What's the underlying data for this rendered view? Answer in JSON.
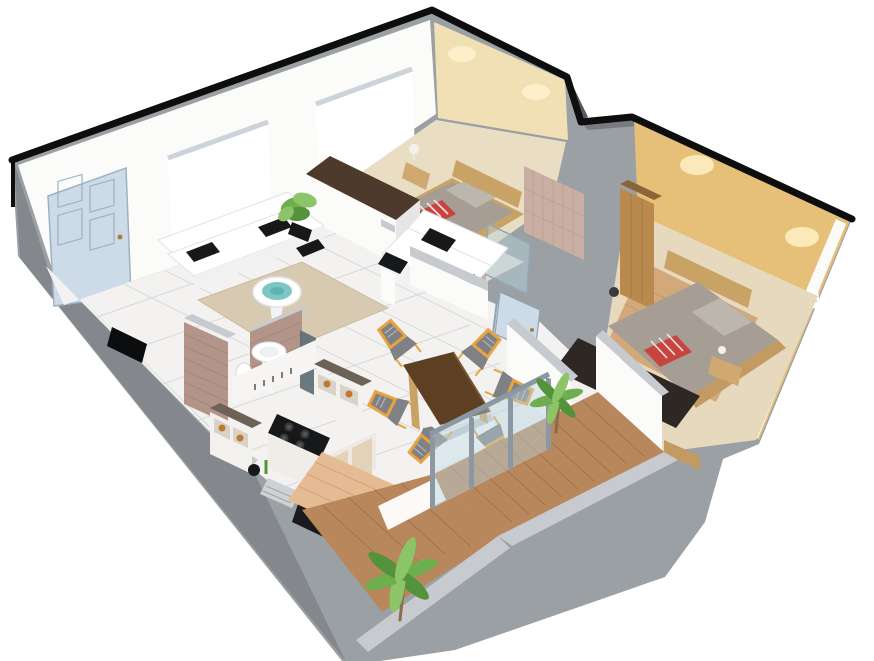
{
  "scene": {
    "type": "3d-floorplan-render",
    "title": "3D isometric cutaway floor plan of a two-bedroom apartment",
    "view": "dollhouse aerial from south",
    "rooms": [
      {
        "name": "Living Room",
        "furniture": [
          "entry-door",
          "window",
          "window",
          "three-seat-sofa",
          "two-seat-sofa",
          "black-cushions",
          "round-coffee-table",
          "area-rug",
          "flat-tv",
          "potted-plant"
        ]
      },
      {
        "name": "Bedroom Two",
        "furniture": [
          "double-bed",
          "wood-headboard",
          "striped-throw",
          "nightstand",
          "table-lamp",
          "wardrobe"
        ]
      },
      {
        "name": "Bathroom",
        "furniture": [
          "toilet",
          "washbasin",
          "glass-shower",
          "mosaic-walls",
          "open-door"
        ]
      },
      {
        "name": "Kitchen",
        "furniture": [
          "brick-partition",
          "pedestal-washbasin",
          "wc",
          "cooktop",
          "counter-cabinets",
          "shelf-unit-with-jars",
          "shelf-unit-with-jars",
          "black-appliance",
          "striped-mat",
          "wood-deck-floor"
        ]
      },
      {
        "name": "Dining Area",
        "furniture": [
          "wood-dining-table",
          "chair",
          "chair",
          "chair",
          "chair",
          "chair",
          "chair"
        ]
      },
      {
        "name": "Master Bedroom",
        "furniture": [
          "double-bed",
          "wood-headboard",
          "pillows",
          "striped-throw",
          "dark-bench",
          "nightstand",
          "table-lamp",
          "tall-wardrobe",
          "ac-unit",
          "gold-wallpaper-walls",
          "ceiling-spotlights"
        ]
      },
      {
        "name": "Hallway",
        "furniture": [
          "palm-plant",
          "open-door",
          "marble-floor"
        ]
      },
      {
        "name": "Balcony",
        "furniture": [
          "plank-deck",
          "palm-plant",
          "sliding-glass-door",
          "parapet-walls"
        ]
      }
    ]
  },
  "palette": {
    "shell": "#9ba0a4",
    "shellDark": "#84878c",
    "cap": "#c7cbd0",
    "capDark": "#6e6257",
    "cutBlack": "#0e0e0f",
    "wall": "#fbfbfa",
    "white": "#ffffff",
    "cream": "#f1e0b4",
    "creamGlow": "#fff3cf",
    "gold": "#e6c078",
    "goldGlow": "#fff0c4",
    "floor": "#f3f2f0",
    "grout": "#dcdcde",
    "floorBeige": "#e9ddc4",
    "floorTan": "#e7d9bd",
    "rug": "#d8cab0",
    "mosaic": "#c9aea4",
    "mosaicLine": "#b09287",
    "brick": "#b29588",
    "brickLine": "#9b8274",
    "woodLight": "#c9a265",
    "woodMid": "#b9894e",
    "woodDark": "#4e3a2c",
    "woodTrim": "#c29a62",
    "deck": "#b8875c",
    "deckLine": "#9c6f4a",
    "deckPink": "#e5bb94",
    "deckPinkLine": "#d3a27c",
    "bed": "#a69e95",
    "pillow": "#bdb6ad",
    "throwRed": "#c8453f",
    "chairYellow": "#e8a33d",
    "chairGray": "#7f8184",
    "tableTop": "#5d3f22",
    "teal": "#7cc7c4",
    "tealDark": "#5db3b0",
    "plant": "#6fae4e",
    "plantDark": "#55923c",
    "plantLight": "#8cc468",
    "trunk": "#8a6b4a",
    "glass": "#b8d2de",
    "frame": "#8b98a4",
    "doorBlue": "#ccdbe7",
    "doorLine": "#9fb2c2",
    "knob": "#a5803c",
    "dark": "#2e2723",
    "black": "#17181a",
    "appliance": "#1b1b1d",
    "jar": "#c07a2e",
    "mat": "#cfd2d4",
    "matLine": "#9fa4a8"
  }
}
